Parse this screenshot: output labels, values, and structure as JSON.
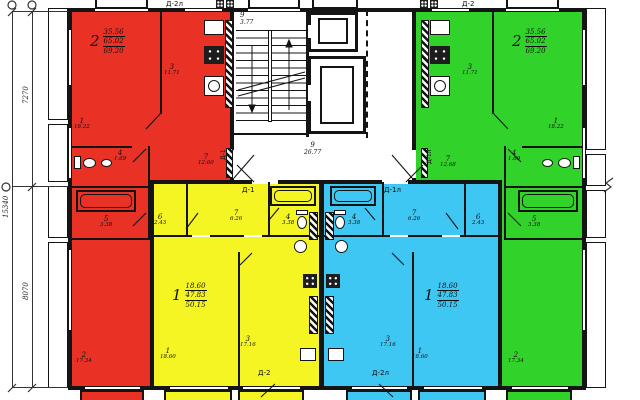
{
  "colors": {
    "red": "#e93126",
    "green": "#31d32b",
    "yellow": "#f5f523",
    "blue": "#3ec7f2",
    "wall": "#141414"
  },
  "dimensions": {
    "left_segment_top": "7270",
    "left_segment_bottom": "8070",
    "left_total": "15340"
  },
  "core": {
    "stairs": {
      "num": "9",
      "area": "3.77"
    },
    "hall": {
      "num": "9",
      "area": "26.77"
    }
  },
  "doors": {
    "top_left": "Д-2л",
    "top_right": "Д-2",
    "entry_left_rot": "Д-1",
    "entry_right_rot": "Д-1л",
    "entry_left": "Д-1",
    "entry_right": "Д-1л",
    "bottom_left": "Д-2",
    "bottom_right": "Д-2л"
  },
  "apartments": [
    {
      "name": "apartment-red",
      "rooms_count": "2",
      "living_area": "35.56",
      "usable_area": "65.02",
      "total_area": "69.20",
      "rooms": [
        {
          "num": "1",
          "area": "18.22"
        },
        {
          "num": "2",
          "area": "17.34"
        },
        {
          "num": "3",
          "area": "11.71"
        },
        {
          "num": "4",
          "area": "1.69"
        },
        {
          "num": "5",
          "area": "3.38"
        },
        {
          "num": "7",
          "area": "12.60"
        }
      ]
    },
    {
      "name": "apartment-green",
      "rooms_count": "2",
      "living_area": "35.56",
      "usable_area": "65.02",
      "total_area": "69.20",
      "rooms": [
        {
          "num": "1",
          "area": "18.22"
        },
        {
          "num": "2",
          "area": "17.34"
        },
        {
          "num": "3",
          "area": "11.71"
        },
        {
          "num": "4",
          "area": "1.69"
        },
        {
          "num": "5",
          "area": "3.38"
        },
        {
          "num": "7",
          "area": "12.68"
        }
      ]
    },
    {
      "name": "apartment-yellow",
      "rooms_count": "1",
      "living_area": "18.60",
      "usable_area": "47.83",
      "total_area": "50.15",
      "rooms": [
        {
          "num": "1",
          "area": "18.60"
        },
        {
          "num": "3",
          "area": "17.16"
        },
        {
          "num": "4",
          "area": "3.38"
        },
        {
          "num": "6",
          "area": "2.43"
        },
        {
          "num": "7",
          "area": "6.26"
        }
      ]
    },
    {
      "name": "apartment-blue",
      "rooms_count": "1",
      "living_area": "18.60",
      "usable_area": "47.83",
      "total_area": "50.15",
      "rooms": [
        {
          "num": "1",
          "area": "18.60"
        },
        {
          "num": "3",
          "area": "17.16"
        },
        {
          "num": "4",
          "area": "3.38"
        },
        {
          "num": "6",
          "area": "2.43"
        },
        {
          "num": "7",
          "area": "6.26"
        }
      ]
    }
  ]
}
